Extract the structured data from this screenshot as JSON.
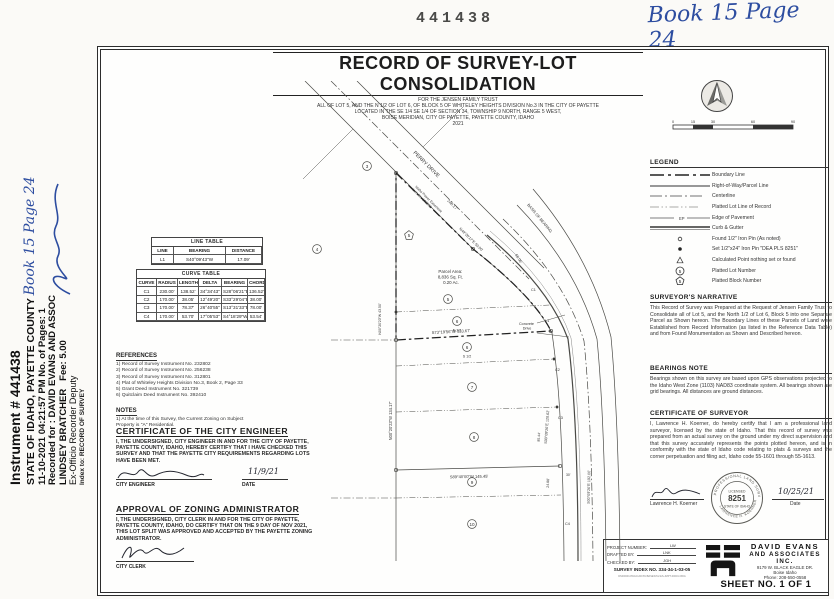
{
  "marks": {
    "stamp_number": "441438",
    "book_page_handwritten": "Book 15 Page 24"
  },
  "recorder": {
    "instrument": "Instrument # 441438",
    "state_line": "STATE OF IDAHO, PAYETTE COUNTY",
    "book_page": "Book 15 Page 24",
    "datetime_line": "11-10-2021    04:21:57 PM    No. of Pages: 1",
    "recorded_for": "Recorded for : DAVID EVANS AND ASSOC",
    "recorder_name": "LINDSEY BRATCHER",
    "fee": "Fee: 5.00",
    "deputy_line": "Ex-Officio Recorder  Deputy",
    "index_line": "Index to: RECORD OF SURVEY"
  },
  "title_block": {
    "title": "RECORD OF SURVEY-LOT CONSOLIDATION",
    "sub1": "FOR THE JENSEN FAMILY TRUST",
    "sub2": "ALL OF LOT 5, AND THE N 1/2 OF LOT 6, OF BLOCK 5 OF WHITELEY HEIGHTS DIVISION No.3 IN THE CITY OF PAYETTE",
    "sub3": "LOCATED IN THE SE 1/4 SE 1/4  OF SECTION 34, TOWNSHIP 9 NORTH, RANGE 5 WEST,",
    "sub4": "BOISE MERIDIAN, CITY OF PAYETTE, PAYETTE COUNTY, IDAHO",
    "sub5": "2021"
  },
  "scale_bar": {
    "ticks": [
      "0",
      "15",
      "30",
      "60",
      "90"
    ]
  },
  "legend": {
    "title": "LEGEND",
    "ep_label": "EP",
    "items": [
      "Boundary Line",
      "Right-of-Way/Parcel Line",
      "Centerline",
      "Platted Lot Line of Record",
      "Edge of Pavement",
      "Curb & Gutter",
      "Found 1/2\" Iron Pin (As noted)",
      "Set 1/2\"x24\" Iron Pin \"DEA PLS 8251\"",
      "Calculated Point nothing set or found",
      "Platted Lot Number",
      "Platted Block Number"
    ],
    "lot_symbol": "5",
    "block_symbol": "5"
  },
  "narrative": {
    "title": "SURVEYOR'S NARRATIVE",
    "body": "This Record of Survey was Prepared at the Request of Jensen Family Trust to Consolidate all of Lot 5, and the North 1/2 of Lot 6, Block 5 into one Separate Parcel as Shown hereon. The Boundary Lines of these Parcels of Land were Established from Record Information (as listed in the Reference Data Table) and from Found Monumentation as Shown and Described hereon."
  },
  "bearings_note": {
    "title": "BEARINGS NOTE",
    "body": "Bearings shown on this survey are based upon GPS observations projected to the Idaho West Zone (1103) NAD83 coordinate system. All bearings shown are grid bearings. All distances are ground distances."
  },
  "cert_surveyor": {
    "title": "CERTIFICATE OF SURVEYOR",
    "body": "I, Lawrence H. Koerner, do hereby certify that I am a professional land surveyor, licensed by the state of Idaho. That this record of survey was prepared from an actual survey on the ground under my direct supervision and that this survey accurately represents the points plotted hereon, and is in conformity with the state of Idaho code relating to plats & surveys and the corner perpetuation and filing act, Idaho code 55-1601 through 55-1613.",
    "printed_name": "Lawrence H. Koerner",
    "date_value": "10/25/21",
    "date_label": "Date",
    "seal": {
      "arc_top": "PROFESSIONAL LAND SURVEYOR",
      "licensed": "LICENSED",
      "number": "8251",
      "state": "STATE OF IDAHO",
      "arc_bottom": "LAWRENCE H. KOERNER"
    }
  },
  "line_table": {
    "title": "LINE TABLE",
    "headers": [
      "LINE",
      "BEARING",
      "DISTANCE"
    ],
    "rows": [
      [
        "L1",
        "S40°09'43\"W",
        "17.09'"
      ]
    ]
  },
  "curve_table": {
    "title": "CURVE TABLE",
    "headers": [
      "CURVE",
      "RADIUS",
      "LENGTH",
      "DELTA",
      "BEARING",
      "CHORD"
    ],
    "rows": [
      [
        "C1",
        "230.00'",
        "138.52'",
        "34°34'43\"",
        "S28°06'21\"E",
        "136.52'"
      ],
      [
        "C2",
        "170.00'",
        "38.05'",
        "12°49'20\"",
        "S33°29'04\"E",
        "38.00'"
      ],
      [
        "C3",
        "170.00'",
        "78.37'",
        "26°40'55\"",
        "S13°31'33\"E",
        "78.00'"
      ],
      [
        "C4",
        "170.00'",
        "53.70'",
        "17°05'53\"",
        "S4°18'29\"W",
        "53.54'"
      ]
    ]
  },
  "references": {
    "title": "REFERENCES",
    "items": [
      "1) Record of Survey Instrument No. 232802",
      "2) Record of Survey Instrument No. 256238",
      "3) Record of Survey Instrument No. 312801",
      "4) Plat of Whiteley Heights Division No.3, Book 2, Page 33",
      "5) Grant Deed Instrument No. 321739",
      "6) Quitclaim Deed Instrument No. 392410"
    ]
  },
  "notes": {
    "title": "NOTES",
    "item1": "1) At the time of this Survey, the Current Zoning on Subject",
    "item2": "Property is \"A\" Residential."
  },
  "city_engineer": {
    "title": "CERTIFICATE OF THE CITY ENGINEER",
    "body": "I, THE UNDERSIGNED, CITY ENGINEER IN AND FOR THE CITY OF PAYETTE, PAYETTE COUNTY, IDAHO, HEREBY CERTIFY THAT I HAVE CHECKED THIS SURVEY AND THAT THE PAYETTE CITY REQUIREMENTS REGARDING LOTS HAVE BEEN MET.",
    "sig_label": "CITY ENGINEER",
    "date_value": "11/9/21",
    "date_label": "DATE"
  },
  "zoning": {
    "title": "APPROVAL OF ZONING ADMINISTRATOR",
    "body": "I, THE UNDERSIGNED, CITY CLERK IN AND FOR THE CITY OF PAYETTE, PAYETTE COUNTY, IDAHO, DO CERTIFY THAT ON THE 9 DAY OF NOV 2021, THIS LOT SPLIT WAS APPROVED AND ACCEPTED BY THE PAYETTE ZONING ADMINISTRATOR.",
    "sig_label": "CITY CLERK"
  },
  "firm": {
    "project_number_label": "PROJECT NUMBER:",
    "project_number": "LW",
    "drafted_label": "DRAFTED BY:",
    "drafted": "LNK",
    "checked_label": "CHECKED BY:",
    "checked": "JGH",
    "survey_index": "SURVEY INDEX NO. 334-34-1-03-05",
    "file_path": "DS00000-DWG\\CAD\\SV\\BASES\\SV-ES-JMPT-00001.DWG",
    "name1": "DAVID EVANS",
    "name2": "AND ASSOCIATES INC.",
    "address": "9179 W. BLACK EAGLE DR.",
    "city": "Boise Idaho",
    "phone": "Phone: 208-550-0558",
    "sheet": "SHEET NO. 1 OF 1"
  },
  "map": {
    "street": "PERRY DRIVE",
    "street_dist": "248.17'",
    "street_brg": "N49°28'17\"E 50.00'",
    "easement1": "Idaho Power Easement",
    "easement2": "Inst. No. 168822",
    "basis": "BASIS OF BEARING",
    "parcel1": "Parcel Area:",
    "parcel2": "8,836 Sq. Ft.",
    "parcel3": "0.20 Ac.",
    "n_half": "N 1/2",
    "s_half": "S 1/2",
    "concrete1": "Concrete",
    "concrete2": "Drive",
    "brg_split": "S73°19'56\"W 133.67'",
    "brg_south": "S89°40'00\"W 145.45'",
    "brg_west": "N00°20'23\"W 134.17'",
    "brg_west2": "N00°20'23\"W 43.50'",
    "brg_east": "S00°09'26\"E 120.62'",
    "brg_cl": "S00°09'26\"E 192.00'",
    "d85": "85.44'",
    "d24": "24.88'",
    "d65": "65.06'",
    "d30": "30'",
    "c1": "C1",
    "c2": "C2",
    "c3": "C3",
    "c4": "C4",
    "l1": "L1",
    "lot3": "3",
    "lot4": "4",
    "blk5": "5",
    "lot5": "5",
    "lot6": "6",
    "lot7": "7",
    "lot8": "8",
    "lot9": "9",
    "lot10": "10"
  }
}
